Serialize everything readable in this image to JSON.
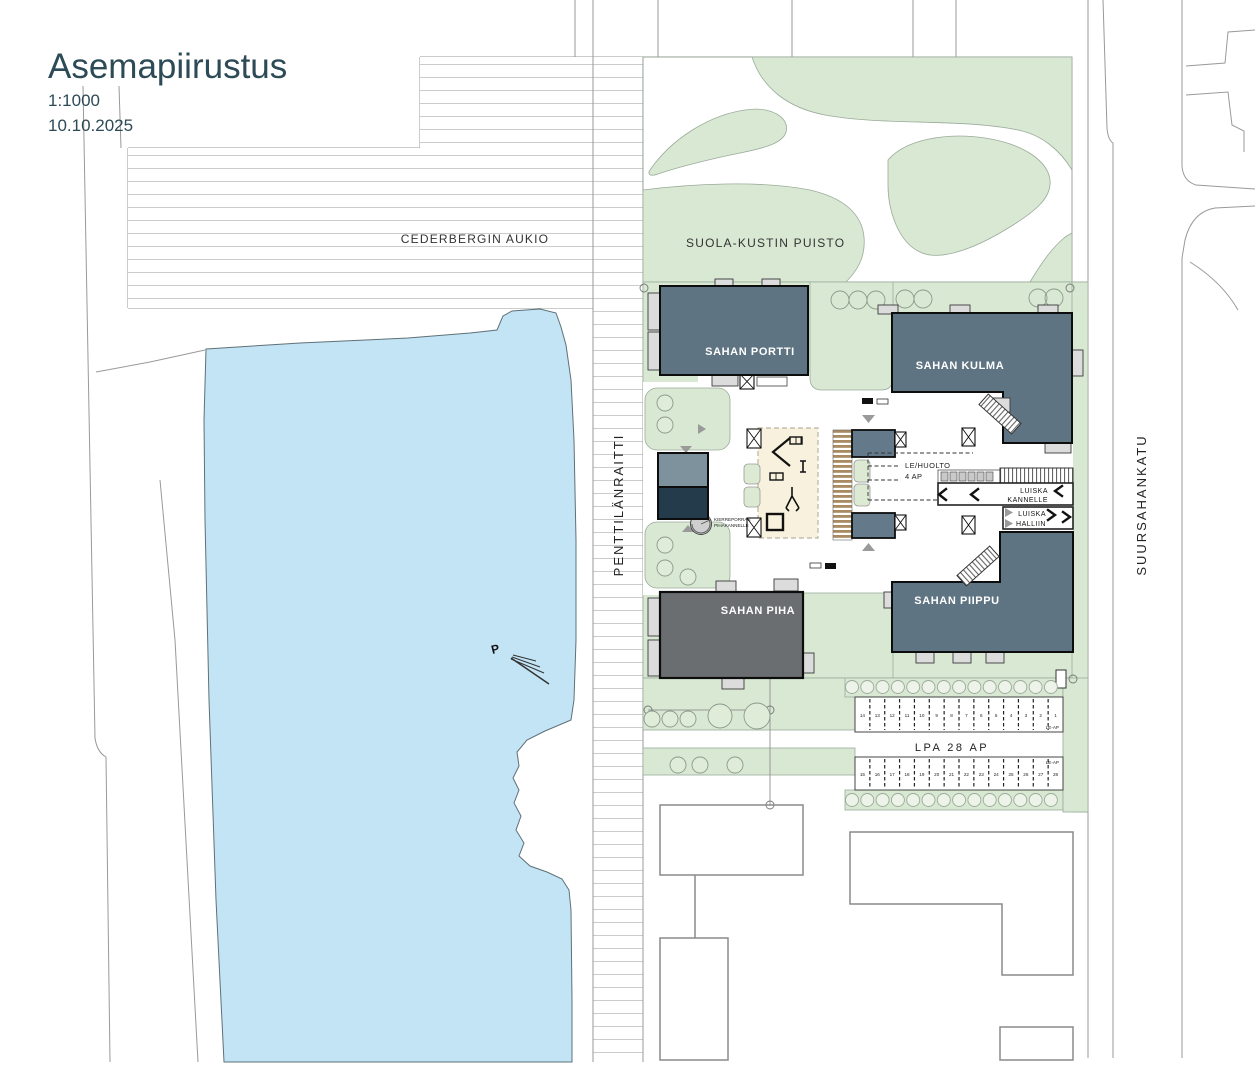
{
  "title": {
    "main": "Asemapiirustus",
    "scale": "1:1000",
    "date": "10.10.2025"
  },
  "areas": {
    "aukio": "CEDERBERGIN AUKIO",
    "puisto": "SUOLA-KUSTIN PUISTO"
  },
  "streets": {
    "west": "PENTTILÄNRAITTI",
    "east": "SUURSAHANKATU"
  },
  "buildings": {
    "portti": "SAHAN PORTTI",
    "kulma": "SAHAN KULMA",
    "piha": "SAHAN PIHA",
    "piippu": "SAHAN PIIPPU"
  },
  "courtyard": {
    "service_line1": "LE/HUOLTO",
    "service_line2": "4 AP",
    "spiral_line1": "KIERREPORRAS",
    "spiral_line2": "PIHAKANNELLE",
    "ramp_deck_line1": "LUISKA",
    "ramp_deck_line2": "KANNELLE",
    "ramp_hall_line1": "LUISKA",
    "ramp_hall_line2": "HALLIIN"
  },
  "north": {
    "label": "P"
  },
  "parking": {
    "label": "LPA  28 AP",
    "le_ap": "LE-AP",
    "row1_numbers": [
      "14",
      "13",
      "12",
      "11",
      "10",
      "9",
      "8",
      "7",
      "6",
      "5",
      "4",
      "3",
      "2",
      "1"
    ],
    "row2_numbers": [
      "15",
      "16",
      "17",
      "18",
      "19",
      "20",
      "21",
      "22",
      "23",
      "24",
      "25",
      "26",
      "27",
      "28"
    ]
  },
  "colors": {
    "title_text": "#2d4a57",
    "building_bluegray": "#5f7482",
    "building_piha_gray": "#6a6e70",
    "building_dark_navy": "#233b4a",
    "water": "#c2e4f4",
    "park_green": "#d8e8d3",
    "wood_deck": "#aa8a60",
    "play_area_cream": "#f8f1dd"
  }
}
